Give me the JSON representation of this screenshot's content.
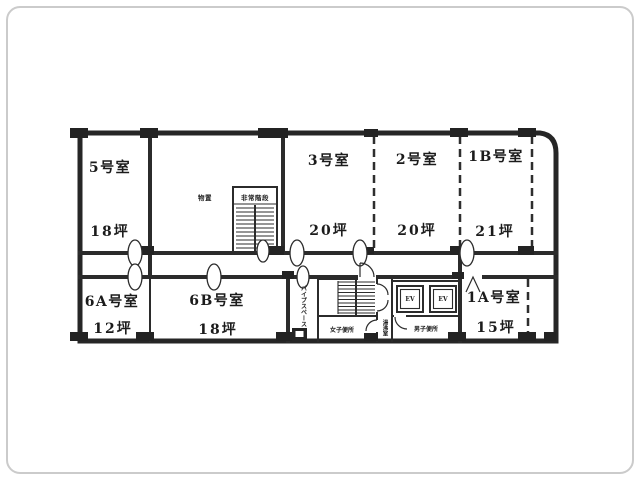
{
  "rooms": {
    "upper": [
      {
        "name": "5号室",
        "area": "18坪"
      },
      {
        "name": "3号室",
        "area": "20坪"
      },
      {
        "name": "2号室",
        "area": "20坪"
      },
      {
        "name": "1B号室",
        "area": "21坪"
      }
    ],
    "lower": [
      {
        "name": "6A号室",
        "area": "12坪"
      },
      {
        "name": "6B号室",
        "area": "18坪"
      },
      {
        "name": "1A号室",
        "area": "15坪"
      }
    ]
  },
  "core": {
    "emergency_stair_label": "非常階段",
    "storage_label": "物置",
    "pipe_space_label": "パイプスペース",
    "womens_toilet_label": "女子便所",
    "mens_toilet_label": "男子便所",
    "kitchenette_label": "湯沸室",
    "elevator_labels": [
      "EV",
      "EV"
    ]
  },
  "colors": {
    "line": "#2b2b2b",
    "background": "#ffffff",
    "frame_border": "#cbcbcb"
  }
}
